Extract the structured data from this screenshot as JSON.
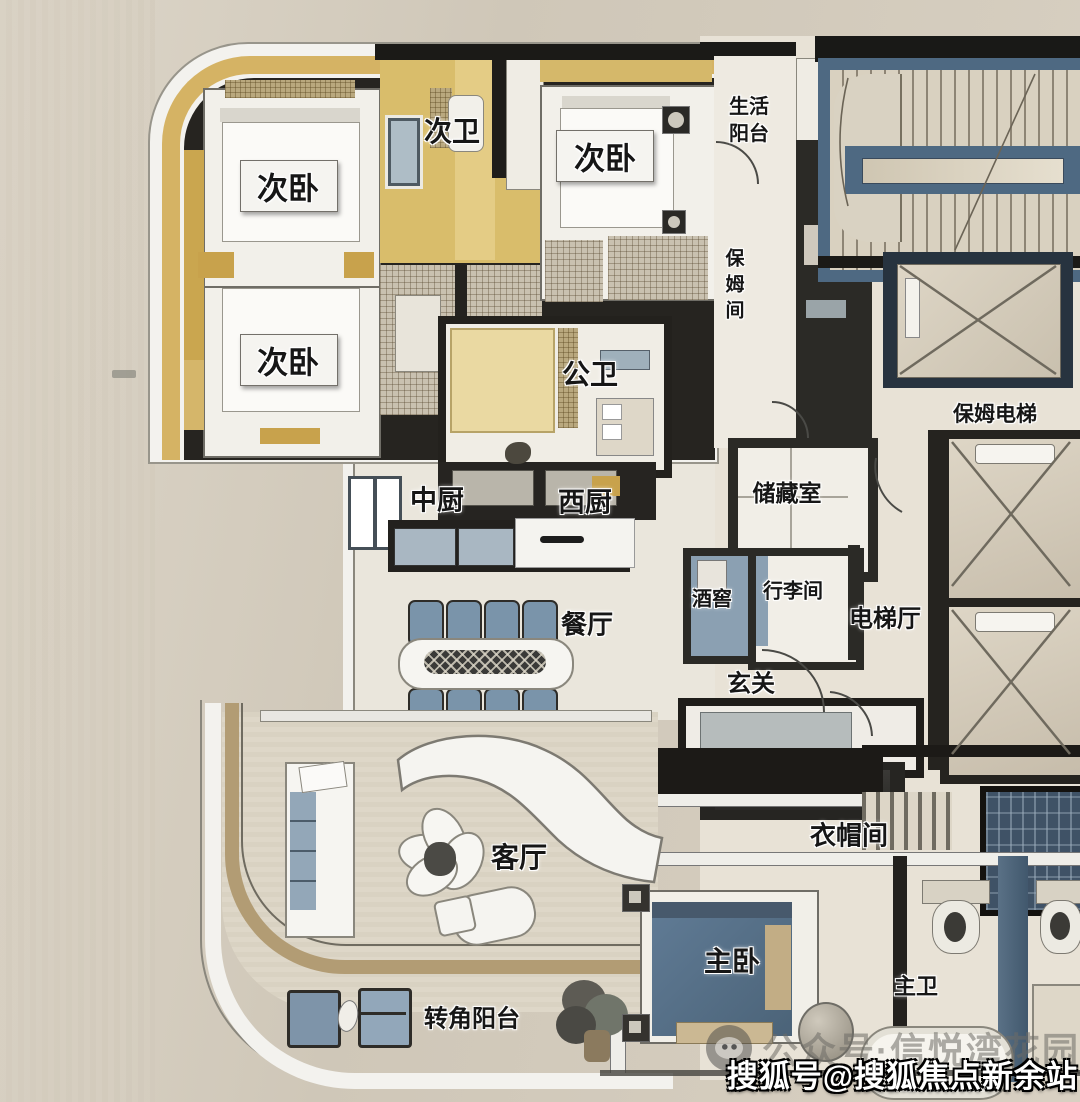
{
  "rooms": [
    {
      "id": "bedroom-top-left",
      "label": "次卧"
    },
    {
      "id": "bathroom-secondary",
      "label": "次卫"
    },
    {
      "id": "bedroom-top-middle",
      "label": "次卧"
    },
    {
      "id": "life-balcony",
      "label": "生活阳台"
    },
    {
      "id": "nanny-room",
      "label": "保姆间"
    },
    {
      "id": "bedroom-mid-left",
      "label": "次卧"
    },
    {
      "id": "public-bathroom",
      "label": "公卫"
    },
    {
      "id": "nanny-elevator",
      "label": "保姆电梯"
    },
    {
      "id": "chinese-kitchen",
      "label": "中厨"
    },
    {
      "id": "western-kitchen",
      "label": "西厨"
    },
    {
      "id": "storage-room",
      "label": "储藏室"
    },
    {
      "id": "wine-cellar",
      "label": "酒窖"
    },
    {
      "id": "luggage-room",
      "label": "行李间"
    },
    {
      "id": "elevator-hall",
      "label": "电梯厅"
    },
    {
      "id": "dining-room",
      "label": "餐厅"
    },
    {
      "id": "foyer",
      "label": "玄关"
    },
    {
      "id": "cloakroom",
      "label": "衣帽间"
    },
    {
      "id": "living-room",
      "label": "客厅"
    },
    {
      "id": "master-bedroom",
      "label": "主卧"
    },
    {
      "id": "master-bathroom",
      "label": "主卫"
    },
    {
      "id": "corner-balcony",
      "label": "转角阳台"
    }
  ],
  "watermarks": {
    "wechat_text": "公众号·信悦湾花园",
    "sohu_text": "搜狐号@搜狐焦点新余站"
  },
  "colors": {
    "gold_accent": "#d5b364",
    "stair_blue": "#4e6982",
    "bed_blue": "#5a7590",
    "wall_dark": "#23211e",
    "floor_beige": "#eae5da",
    "wood_band": "#b29c74"
  }
}
